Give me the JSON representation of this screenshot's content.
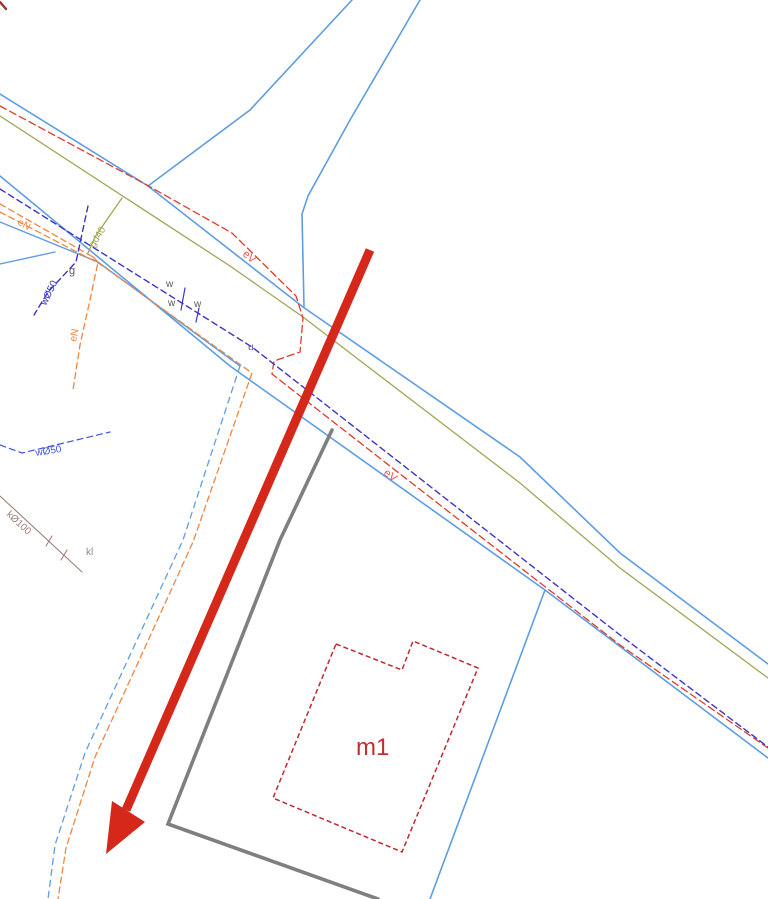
{
  "map": {
    "background": "#ffffff",
    "canvas": {
      "width": 768,
      "height": 899
    },
    "legend_colors": {
      "parcel_road_blue": "#5f9de2",
      "water_navy": "#3b35c6",
      "water_branch_blue": "#3d55dd",
      "electric_red": "#e23b28",
      "electric_orange": "#f08540",
      "gas_olive": "#a2a558",
      "sewer_brown": "#9d8078",
      "fence_gray": "#7f7f7f",
      "building_red": "#c0282d",
      "arrow_red": "#d6281a"
    },
    "lines": [
      {
        "name": "road-edge-north",
        "color": "#5f9de2",
        "width": 1.6,
        "dash": "",
        "points": "0,94 148,186 303,307 520,457 620,553 768,664"
      },
      {
        "name": "road-branch-left-edge",
        "color": "#5f9de2",
        "width": 1.6,
        "dash": "",
        "points": "352,0 250,110 148,186"
      },
      {
        "name": "road-branch-right-edge",
        "color": "#5f9de2",
        "width": 1.6,
        "dash": "",
        "points": "420,0 350,120 308,196 302,214 304,307"
      },
      {
        "name": "road-edge-south",
        "color": "#5f9de2",
        "width": 1.6,
        "dash": "",
        "points": "0,176 230,366 545,590 768,758"
      },
      {
        "name": "parcel-boundary-east",
        "color": "#5f9de2",
        "width": 1.6,
        "dash": "",
        "points": "545,590 430,899"
      },
      {
        "name": "sidewalk-edge-west",
        "color": "#5f9de2",
        "width": 1.4,
        "dash": "",
        "points": "0,222 98,262 240,366"
      },
      {
        "name": "parcel-wedge-west",
        "color": "#5f9de2",
        "width": 1.4,
        "dash": "",
        "points": "0,264 55,252"
      },
      {
        "name": "branch-road-blue-edge",
        "color": "#5f9de2",
        "width": 1.3,
        "dash": "6 5",
        "points": "240,366 183,540 85,753 55,845 48,899"
      },
      {
        "name": "electric-orange-line-a",
        "color": "#f08540",
        "width": 1.3,
        "dash": "6 4",
        "points": "0,204 93,257"
      },
      {
        "name": "electric-orange-stub",
        "color": "#f08540",
        "width": 1.3,
        "dash": "6 4",
        "points": "93,257 98,262 90,300 80,345 73,390"
      },
      {
        "name": "electric-orange-line-b",
        "color": "#f08540",
        "width": 1.3,
        "dash": "6 4",
        "points": "0,212 100,264 252,373 193,542 95,757 66,848 58,899"
      },
      {
        "name": "gas-main-olive",
        "color": "#a2a558",
        "width": 1.3,
        "dash": "",
        "points": "0,116 230,266 303,317 520,483 620,568 768,678"
      },
      {
        "name": "gas-branch-olive",
        "color": "#a2a558",
        "width": 1.3,
        "dash": "",
        "points": "122,198 106,221 95,237 88,253"
      },
      {
        "name": "electric-cable-eV",
        "color": "#e23b28",
        "width": 1.3,
        "dash": "7 4",
        "points": "0,106 145,184 232,233 296,296 303,318 300,352 274,361 272,374 395,470 620,645 768,748"
      },
      {
        "name": "water-main-navy",
        "color": "#3b35c6",
        "width": 1.4,
        "dash": "6 4",
        "points": "0,189 252,347 620,635 768,747"
      },
      {
        "name": "water-branch-navy",
        "color": "#3b35c6",
        "width": 1.4,
        "dash": "6 4",
        "points": "88,206 76,262 48,292 34,315"
      },
      {
        "name": "water-tick-1",
        "color": "#3b35c6",
        "width": 1.2,
        "dash": "",
        "points": "185,288 181,310"
      },
      {
        "name": "water-tick-2",
        "color": "#3b35c6",
        "width": 1.2,
        "dash": "",
        "points": "199,308 196,322"
      },
      {
        "name": "water-service-w50",
        "color": "#3d55dd",
        "width": 1.2,
        "dash": "6 4",
        "points": "0,445 22,453 110,432"
      },
      {
        "name": "sewer-k100",
        "color": "#9d8078",
        "width": 1.1,
        "dash": "",
        "points": "0,496 82,572"
      },
      {
        "name": "sewer-tick-1",
        "color": "#9d8078",
        "width": 1.1,
        "dash": "",
        "points": "52,536 46,546"
      },
      {
        "name": "sewer-tick-2",
        "color": "#9d8078",
        "width": 1.1,
        "dash": "",
        "points": "67,550 61,560"
      },
      {
        "name": "fence-line-gray",
        "color": "#7f7f7f",
        "width": 3.6,
        "dash": "",
        "points": "332,430 280,540 168,824 378,899"
      },
      {
        "name": "corner-red-mark",
        "color": "#a03028",
        "width": 2.4,
        "dash": "",
        "points": "0,2 6,9"
      }
    ],
    "building": {
      "name": "building-outline-m1",
      "color": "#c0282d",
      "width": 1.5,
      "dash": "5 3",
      "points": "336,644 402,670 413,641 478,668 402,852 273,798",
      "label": "m1"
    },
    "arrow": {
      "name": "annotation-arrow",
      "color": "#d6281a",
      "shaft": "370,250 126,810",
      "shaft_width": 9,
      "head": "106,854 145,822 112,801"
    },
    "labels": [
      {
        "name": "label-eV-1",
        "text": "eV",
        "x": 242,
        "y": 255,
        "rot": 40,
        "size": 11,
        "color": "#e8554a"
      },
      {
        "name": "label-eV-2",
        "text": "eV",
        "x": 383,
        "y": 474,
        "rot": 38,
        "size": 11,
        "color": "#e8554a"
      },
      {
        "name": "label-gd40",
        "text": "gd40",
        "x": 94,
        "y": 248,
        "rot": -58,
        "size": 10,
        "color": "#a2a558"
      },
      {
        "name": "label-w50-branch",
        "text": "wØ50",
        "x": 46,
        "y": 306,
        "rot": -64,
        "size": 10,
        "color": "#3b35c6"
      },
      {
        "name": "label-eN-stub",
        "text": "eN",
        "x": 76,
        "y": 342,
        "rot": -79,
        "size": 10,
        "color": "#f08540"
      },
      {
        "name": "label-eN-pair",
        "text": "eN",
        "x": 17,
        "y": 224,
        "rot": 30,
        "size": 10,
        "color": "#f08540"
      },
      {
        "name": "label-w-1",
        "text": "w",
        "x": 166,
        "y": 287,
        "rot": 0,
        "size": 10,
        "color": "#5a5a5a"
      },
      {
        "name": "label-w-2",
        "text": "w",
        "x": 168,
        "y": 306,
        "rot": 0,
        "size": 10,
        "color": "#5a5a5a"
      },
      {
        "name": "label-w-3",
        "text": "w",
        "x": 194,
        "y": 307,
        "rot": 0,
        "size": 10,
        "color": "#5a5a5a"
      },
      {
        "name": "label-g",
        "text": "g",
        "x": 69,
        "y": 274,
        "rot": 0,
        "size": 11,
        "color": "#5a5a5a"
      },
      {
        "name": "label-u",
        "text": "u",
        "x": 248,
        "y": 350,
        "rot": 0,
        "size": 10,
        "color": "#55557a"
      },
      {
        "name": "label-w50-service",
        "text": "wØ50",
        "x": 36,
        "y": 456,
        "rot": -9,
        "size": 10,
        "color": "#3d55dd"
      },
      {
        "name": "label-k100",
        "text": "kØ100",
        "x": 6,
        "y": 515,
        "rot": 43,
        "size": 10,
        "color": "#9d8078"
      },
      {
        "name": "label-kl",
        "text": "kl",
        "x": 86,
        "y": 555,
        "rot": 0,
        "size": 10,
        "color": "#8a8a8a"
      },
      {
        "name": "label-m1",
        "text": "m1",
        "x": 356,
        "y": 755,
        "rot": 0,
        "size": 24,
        "color": "#c13030"
      }
    ]
  }
}
